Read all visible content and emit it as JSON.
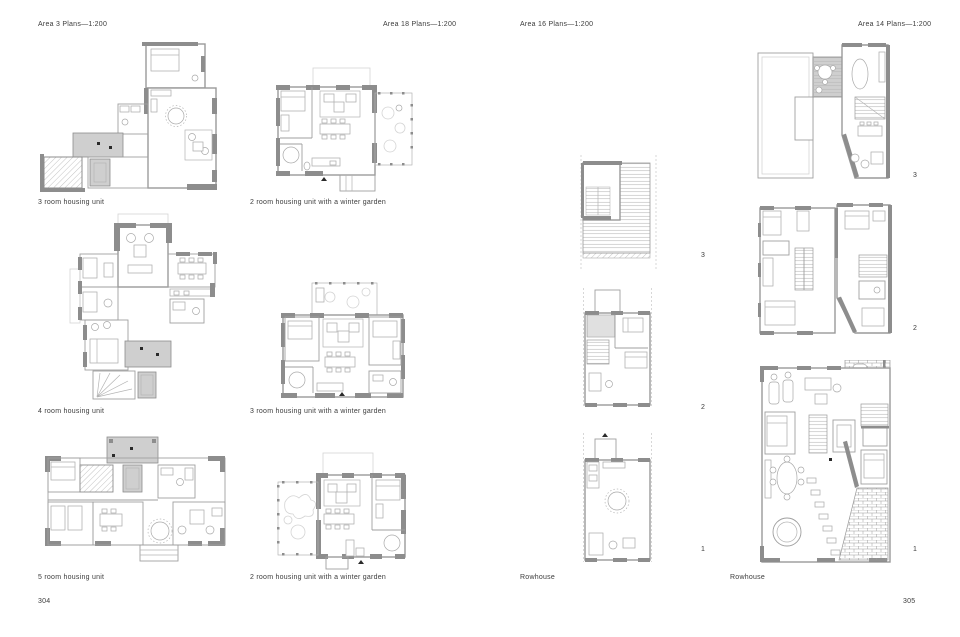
{
  "spread": {
    "left_page": {
      "page_number": "304",
      "headers": [
        "Area 3 Plans—1:200",
        "Area 18 Plans—1:200"
      ],
      "plans": [
        {
          "caption": "3 room housing unit"
        },
        {
          "caption": "2 room housing unit with a winter garden"
        },
        {
          "caption": "4 room housing unit"
        },
        {
          "caption": "3 room housing unit with a winter garden"
        },
        {
          "caption": "5 room housing unit"
        },
        {
          "caption": "2 room housing unit with a winter garden"
        }
      ]
    },
    "right_page": {
      "page_number": "305",
      "headers": [
        "Area 16 Plans—1:200",
        "Area 14 Plans—1:200"
      ],
      "rowhouses": [
        {
          "caption": "Rowhouse",
          "levels": [
            "3",
            "2",
            "1"
          ]
        },
        {
          "caption": "Rowhouse",
          "levels": [
            "3",
            "2",
            "1"
          ]
        }
      ]
    },
    "colors": {
      "paper": "#ffffff",
      "wall_dark": "#8d8d8d",
      "wall_line": "#9a9a9a",
      "shade": "#cfcfcf",
      "text": "#3c3c3c"
    }
  }
}
